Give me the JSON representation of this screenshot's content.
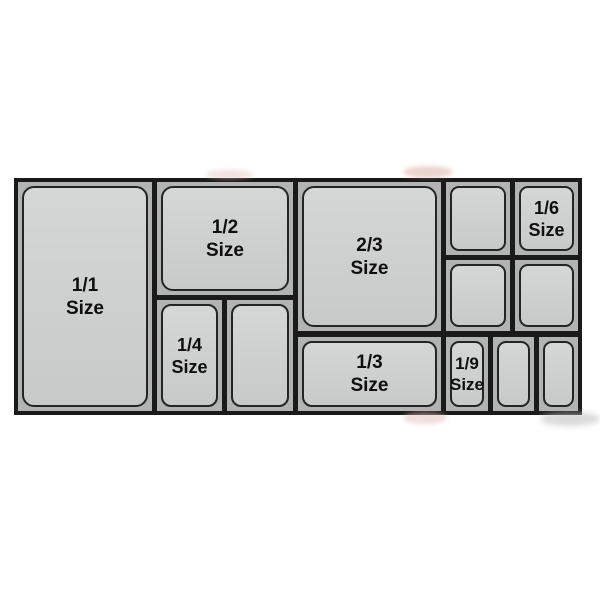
{
  "diagram": {
    "name": "Gastronorm pan size chart",
    "labels": {
      "full": {
        "fraction": "1/1",
        "word": "Size"
      },
      "half": {
        "fraction": "1/2",
        "word": "Size"
      },
      "two_thirds": {
        "fraction": "2/3",
        "word": "Size"
      },
      "third": {
        "fraction": "1/3",
        "word": "Size"
      },
      "quarter": {
        "fraction": "1/4",
        "word": "Size"
      },
      "sixth": {
        "fraction": "1/6",
        "word": "Size"
      },
      "ninth": {
        "fraction": "1/9",
        "word": "Size"
      }
    },
    "unlabeled_pan_count": 6
  },
  "colors": {
    "page_bg": "#ffffff",
    "frame": "#1a1a1a",
    "cell_bg": "#b2b3b3",
    "pan_fill_top": "#d5d6d6",
    "pan_fill_bottom": "#c8c9c9",
    "pan_outline": "#242424",
    "label": "#0e0e0e"
  }
}
